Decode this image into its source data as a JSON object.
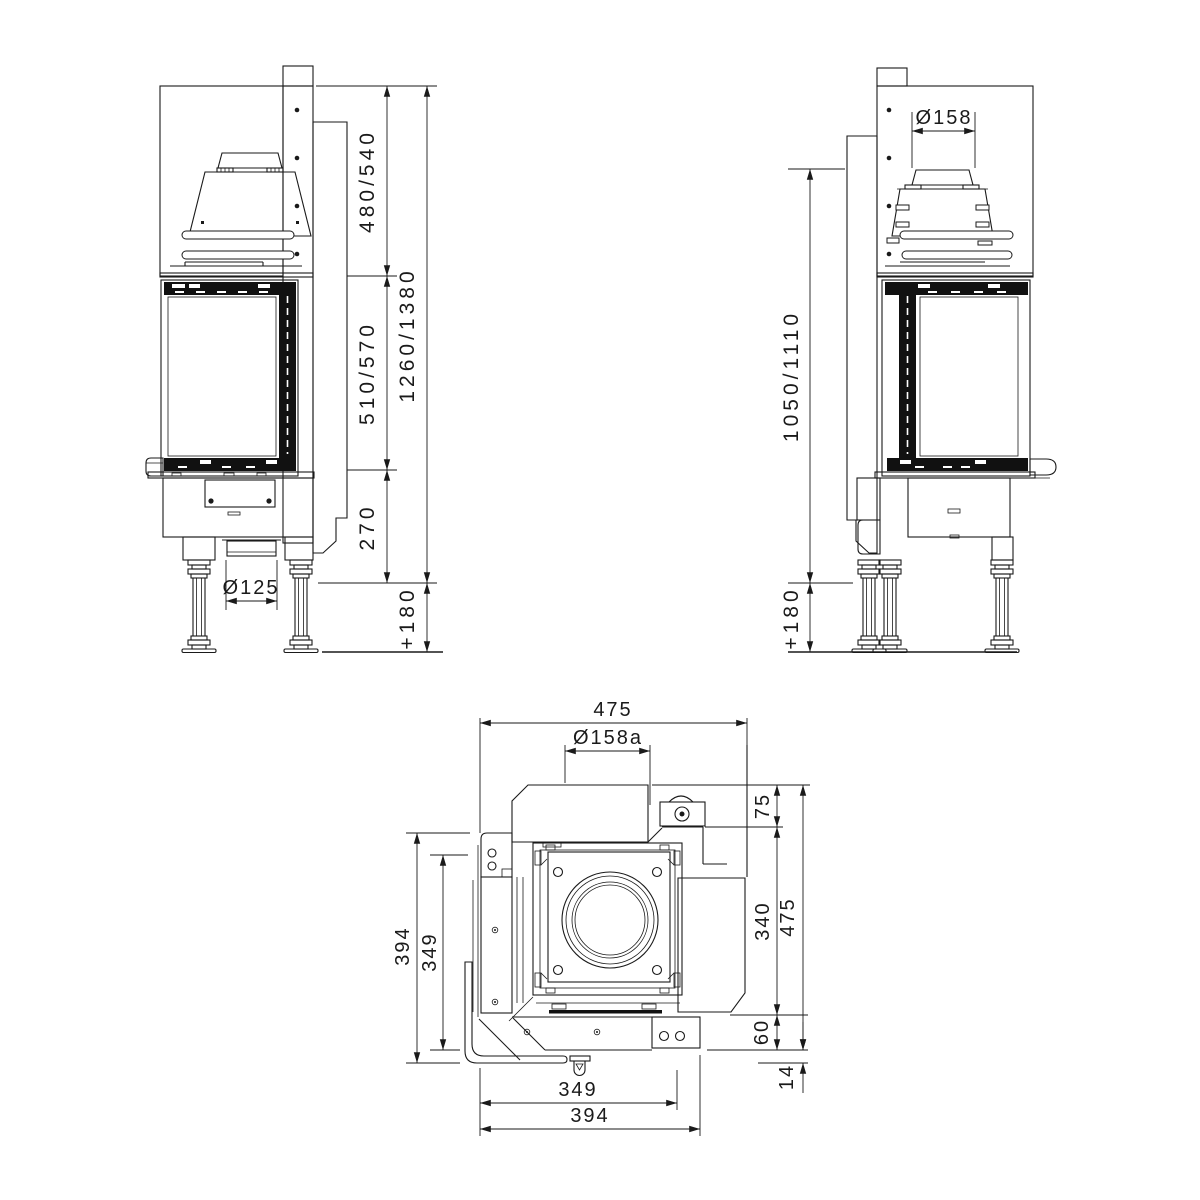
{
  "colors": {
    "line": "#1a1a1a",
    "background": "#ffffff"
  },
  "front_view": {
    "section_top": "480/540",
    "section_glass": "510/570",
    "section_base": "270",
    "total_height": "1260/1380",
    "legs_height": "+180",
    "duct_diameter": "Ø125"
  },
  "side_view": {
    "flue_diameter": "Ø158",
    "height_to_flue": "1050/1110",
    "legs_height": "+180"
  },
  "top_view": {
    "width_overall": "475",
    "flue_diameter": "Ø158a",
    "offset_top": "75",
    "depth_mid": "340",
    "depth_overall": "475",
    "rear_edge": "60",
    "frame_gap": "14",
    "glass_width": "349",
    "body_width": "394",
    "side_glass_width": "349",
    "side_body_width": "394"
  }
}
